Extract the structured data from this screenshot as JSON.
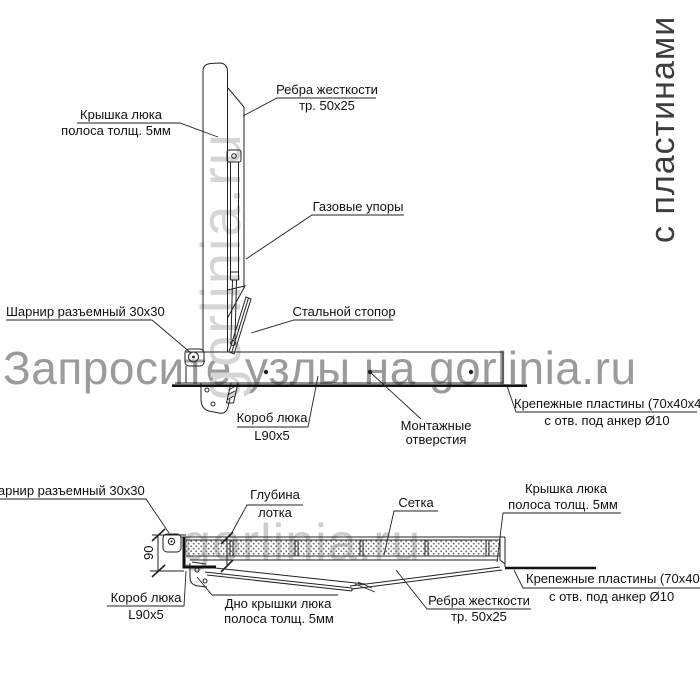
{
  "side_caption": "с пластинами",
  "watermarks": {
    "main": "Запросите узлы на gorlinia.ru",
    "vertical_top": "gorlinia.ru",
    "bottom": "gorlinia.ru"
  },
  "colors": {
    "line": "#222222",
    "thick_line": "#111111",
    "label_text": "#111111",
    "watermark_main": "#9b9b9b",
    "watermark_light": "#d5d5d5",
    "side_caption_text": "#3d3d3d"
  },
  "top_view": {
    "labels": {
      "cover": {
        "line1": "Крышка люка",
        "line2": "полоса толщ. 5мм"
      },
      "ribs": {
        "line1": "Ребра жесткости",
        "line2": "тр. 50x25"
      },
      "gas_struts": {
        "line1": "Газовые упоры"
      },
      "hinge": {
        "line1": "Шарнир разъемный 30x30"
      },
      "stopper": {
        "line1": "Стальной стопор"
      },
      "box": {
        "line1": "Короб люка",
        "line2": "L90x5"
      },
      "mounting_holes": {
        "line1": "Монтажные",
        "line2": "отверстия"
      },
      "plates": {
        "line1": "Крепежные пластины (70x40x4)",
        "line2": "с отв. под анкер Ø10"
      }
    }
  },
  "bottom_view": {
    "labels": {
      "hinge": {
        "line1": "Шарнир разъемный 30x30"
      },
      "tray_depth": {
        "line1": "Глубина",
        "line2": "лотка"
      },
      "mesh": {
        "line1": "Сетка"
      },
      "cover": {
        "line1": "Крышка люка",
        "line2": "полоса толщ. 5мм"
      },
      "plates": {
        "line1": "Крепежные пластины (70x40x4)",
        "line2": "с отв. под анкер Ø10"
      },
      "ribs": {
        "line1": "Ребра жесткости",
        "line2": "тр. 50x25"
      },
      "cover_bottom": {
        "line1": "Дно крышки люка",
        "line2": "полоса толщ. 5мм"
      },
      "box": {
        "line1": "Короб люка",
        "line2": "L90x5"
      },
      "depth_dimension": "90"
    }
  }
}
